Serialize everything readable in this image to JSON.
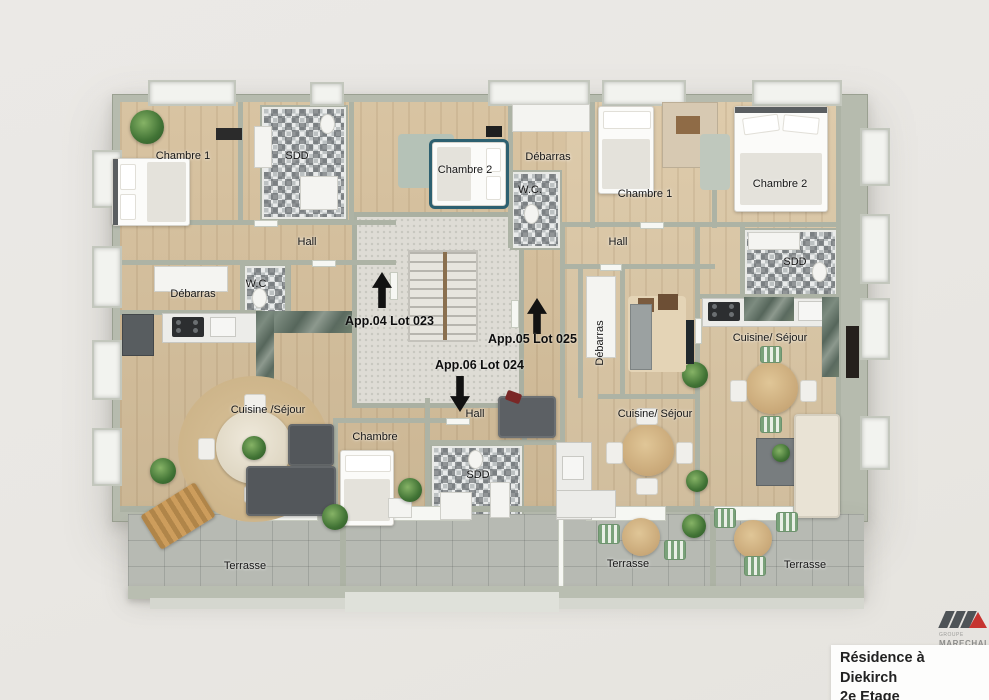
{
  "meta": {
    "title_line1": "Résidence à Diekirch",
    "title_line2": "2e Etage"
  },
  "logo": {
    "group": "GROUPE",
    "brand": "MARECHAL"
  },
  "colors": {
    "background": "#e9e7e3",
    "wall_sage": "#b6bbae",
    "wood_floor": "#d6c09c",
    "terrazzo": "#dedcd5",
    "terrace_tile": "#b7bab3",
    "accent_red": "#c63430",
    "logo_gray": "#4e5357",
    "label_text": "#161616"
  },
  "apartments": [
    {
      "label": "App.04 Lot 023",
      "direction": "up"
    },
    {
      "label": "App.05 Lot 025",
      "direction": "up"
    },
    {
      "label": "App.06 Lot 024",
      "direction": "down"
    }
  ],
  "rooms": {
    "chambre1_nw": "Chambre 1",
    "sdd_nw": "SDD",
    "chambre2_n": "Chambre 2",
    "debarras_n": "Débarras",
    "wc_n": "W.C.",
    "chambre1_ne": "Chambre 1",
    "chambre2_ne": "Chambre 2",
    "hall_w": "Hall",
    "hall_e": "Hall",
    "sdd_e": "SDD",
    "debarras_w": "Débarras",
    "wc_w": "W.C",
    "debarras_mid": "Débarras",
    "cuisine_sejour_w": "Cuisine /Séjour",
    "cuisine_sejour_e": "Cuisine/ Séjour",
    "cuisine_sejour_s": "Cuisine/ Séjour",
    "chambre_s": "Chambre",
    "hall_s": "Hall",
    "sdd_s": "SDD",
    "terrasse_w": "Terrasse",
    "terrasse_s": "Terrasse",
    "terrasse_e": "Terrasse"
  }
}
